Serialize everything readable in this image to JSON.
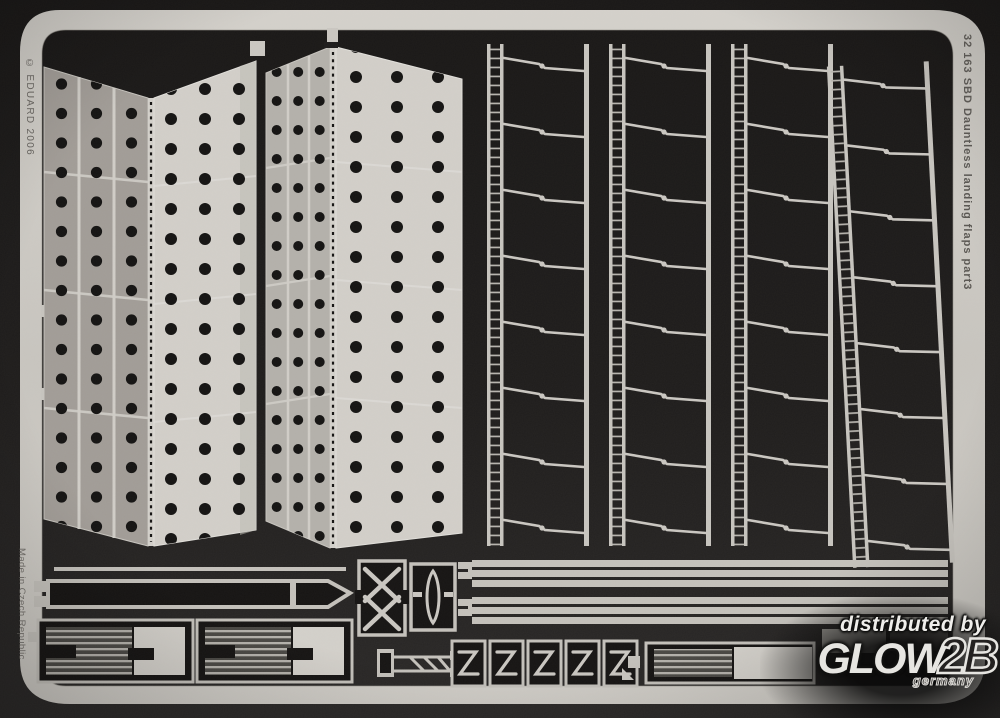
{
  "photo": {
    "kind": "photo-etched model detail fret",
    "frame": {
      "code_text": "32 163 SBD Dauntless landing flaps  part3",
      "copyright_text": "© EDUARD 2006",
      "made_in_text": "Made in Czech Republic"
    },
    "colors": {
      "background": "#1d1b1a",
      "metal_light": "#cdcac4",
      "plate_light": "#d1cec8",
      "plate_mid": "#b3b0aa",
      "plate_dark": "#a19c96",
      "hole_dark": "#161413",
      "etched_text": "#55524e"
    }
  },
  "watermark": {
    "line1": "distributed by",
    "brand_main": "GLOW",
    "brand_suffix": "2B",
    "country": "germany"
  }
}
